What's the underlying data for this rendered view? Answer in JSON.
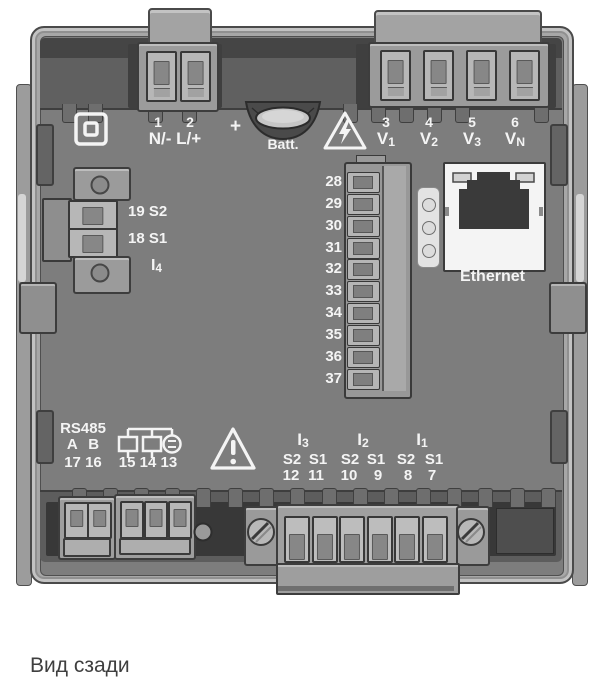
{
  "caption": "Вид сзади",
  "power_terminal": {
    "pin_a": "1",
    "pin_b": "2",
    "label": "N/- L/+"
  },
  "battery": {
    "plus": "+",
    "label": "Batt."
  },
  "voltage_inputs": {
    "pins": [
      "3",
      "4",
      "5",
      "6"
    ],
    "labels": [
      {
        "base": "V",
        "sub": "1"
      },
      {
        "base": "V",
        "sub": "2"
      },
      {
        "base": "V",
        "sub": "3"
      },
      {
        "base": "V",
        "sub": "N"
      }
    ]
  },
  "aux_current": {
    "row1": "19 S2",
    "row2": "18 S1",
    "label": {
      "base": "I",
      "sub": "4"
    }
  },
  "terminal_strip": {
    "numbers": [
      "28",
      "29",
      "30",
      "31",
      "32",
      "33",
      "34",
      "35",
      "36",
      "37"
    ]
  },
  "ethernet": {
    "label": "Ethernet"
  },
  "rs485": {
    "title": "RS485",
    "ab": "A B",
    "pins": "17 16"
  },
  "digital_io": {
    "pins": "15 14 13"
  },
  "current_inputs": {
    "groups": [
      {
        "name": {
          "base": "I",
          "sub": "3"
        },
        "s2": "S2",
        "s1": "S1",
        "pin_s2": "12",
        "pin_s1": "11"
      },
      {
        "name": {
          "base": "I",
          "sub": "2"
        },
        "s2": "S2",
        "s1": "S1",
        "pin_s2": "10",
        "pin_s1": "9"
      },
      {
        "name": {
          "base": "I",
          "sub": "1"
        },
        "s2": "S2",
        "s1": "S1",
        "pin_s2": "8",
        "pin_s1": "7"
      }
    ]
  },
  "colors": {
    "panel": "#7d7d7d",
    "dark_band": "#5d5d5d",
    "frame": "#a7a7a7",
    "label_text": "#f4f4f4",
    "caption_text": "#3f3f3f",
    "ethernet_bezel": "#f4f4f4"
  }
}
